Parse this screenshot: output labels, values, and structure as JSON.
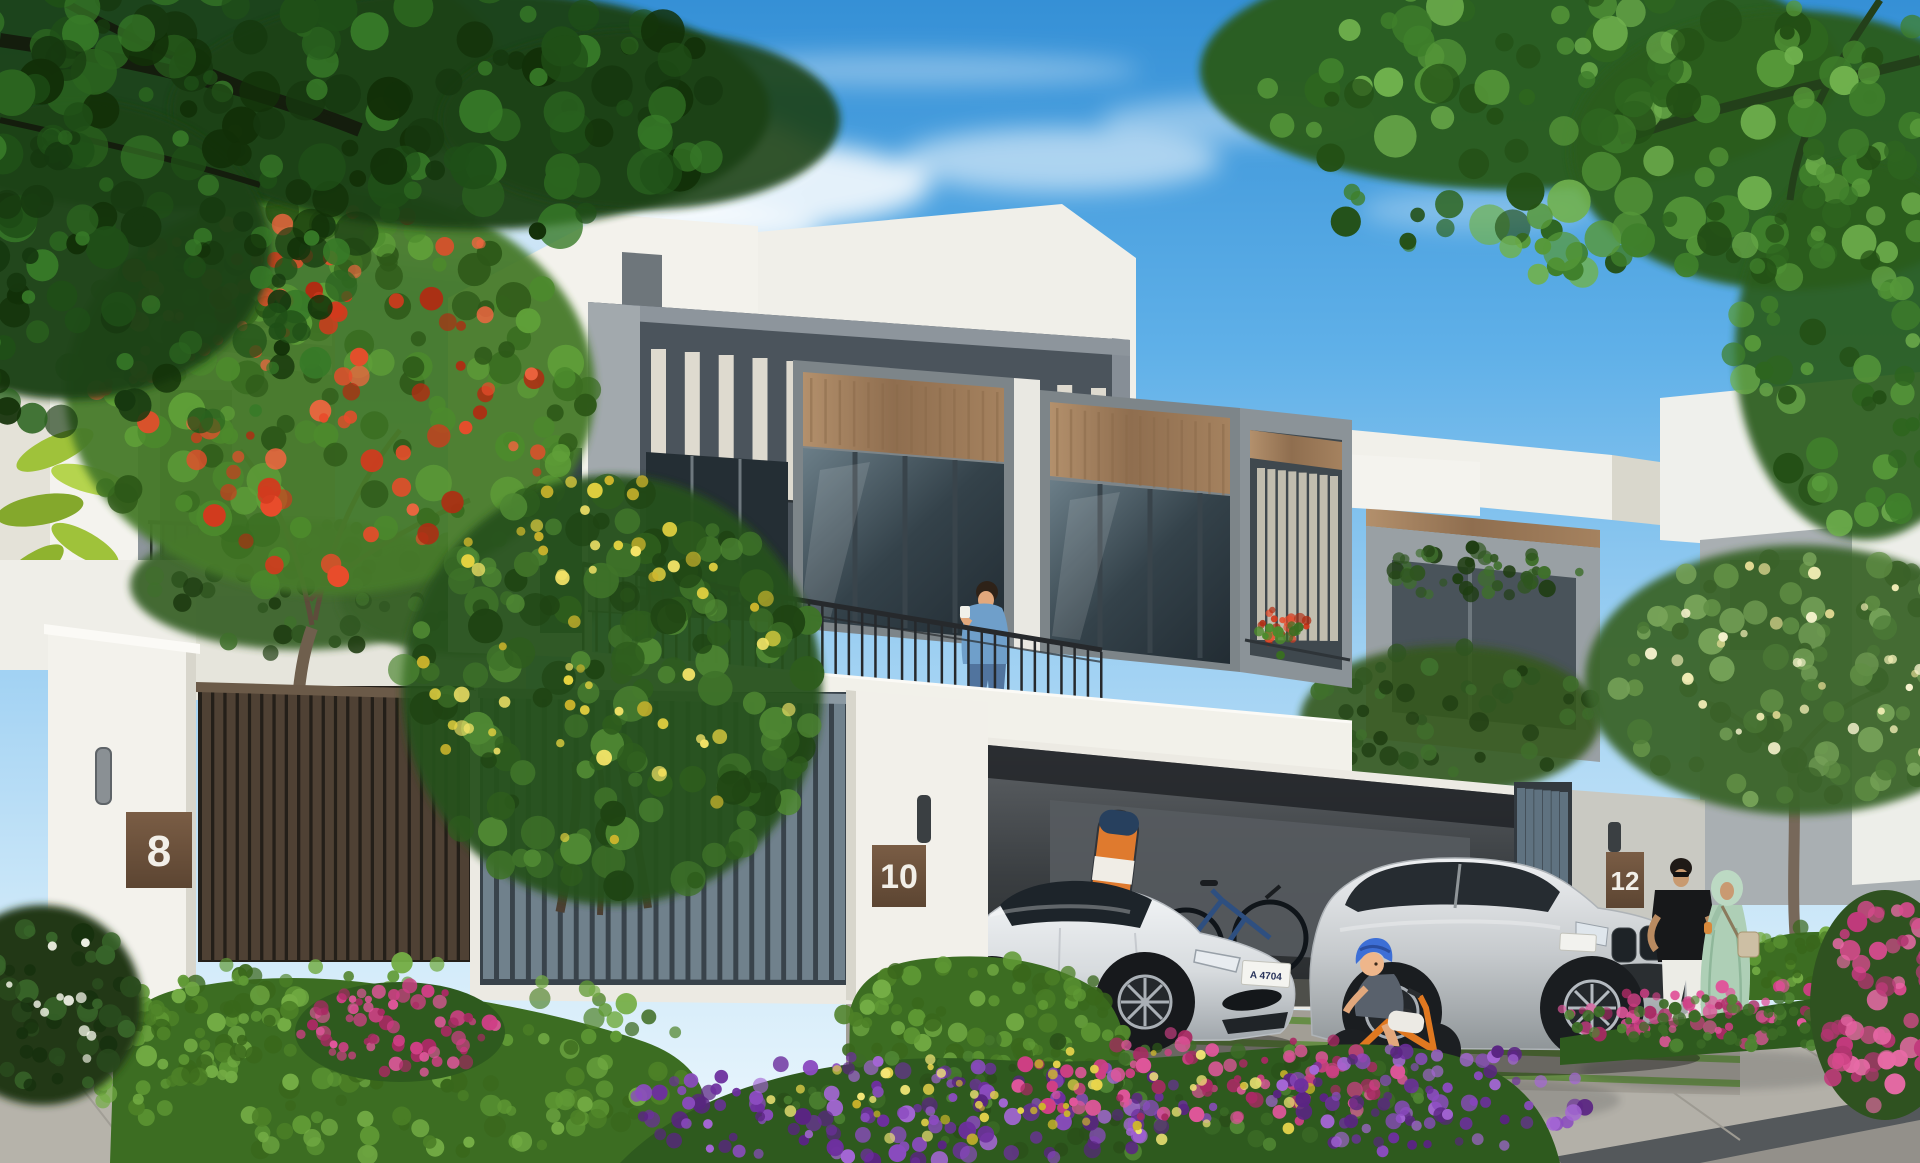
{
  "scene": {
    "house_numbers": {
      "villa_8": "8",
      "villa_10": "10",
      "villa_12": "12"
    },
    "sedan_license_plate": "A 4704"
  },
  "colors": {
    "sky_top": "#3590d6",
    "sky_horizon": "#eef8fd",
    "wall_white": "#f3f2ec",
    "concrete_gray": "#8d959c",
    "wood_accent": "#a5825f",
    "address_panel_brown": "#6e543f",
    "poinciana_red": "#d23a1e",
    "hedge_green": "#4d8127",
    "flower_purple": "#8b4bc0",
    "flower_magenta": "#cf3f85",
    "flower_yellow": "#e8d44c",
    "balance_bike_orange": "#e07820",
    "abaya_mint": "#aecfb6",
    "asphalt": "#54585b"
  }
}
